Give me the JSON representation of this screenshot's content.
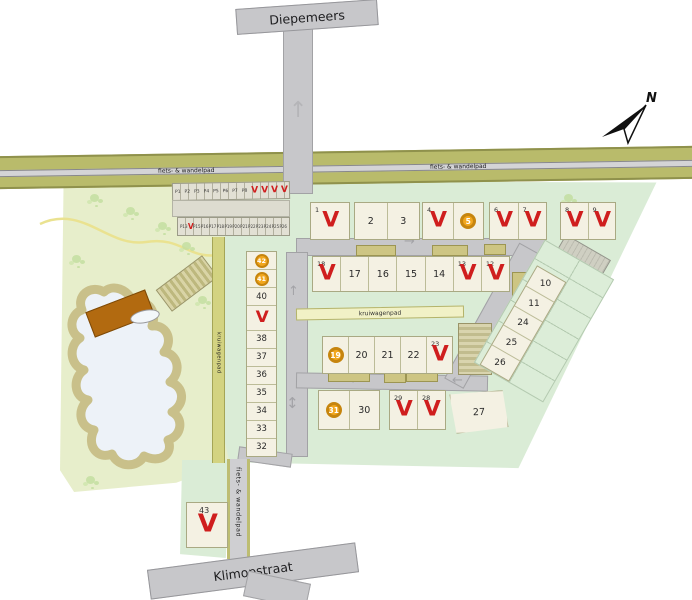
{
  "streets": {
    "top": "Diepemeers",
    "bottom": "Klimopstraat"
  },
  "paths": {
    "bike_top_left": "fiets- & wandelpad",
    "bike_top_right": "fiets- & wandelpad",
    "bike_south": "fiets- & wandelpad",
    "wheelbarrow": "kruiwagenpad",
    "wheelbarrow_side": "kruiwagenpad"
  },
  "compass": {
    "label": "N"
  },
  "markers": {
    "sold": "V"
  },
  "icons": {
    "arrow_up": "↑",
    "arrow_down": "↓",
    "arrow_left": "←",
    "arrow_right": "→",
    "arrow_up_down": "↕"
  },
  "colors": {
    "sold_red": "#cf1e1e",
    "option_orange": "#f2a71e",
    "plot_cream": "#f4f1e3",
    "site_green": "#daecd6",
    "field_green": "#e7eecb",
    "band_olive": "#b9bb6b",
    "road_gray": "#c7c7ca",
    "pond_water": "#edf2f8",
    "pond_bank": "#c9c08a",
    "deck_brown": "#b26a10"
  },
  "parking": {
    "row1": [
      "P1",
      "P2",
      "P3",
      "P4",
      "P5",
      "P6",
      "P7",
      "P8"
    ],
    "row2_first": "P13",
    "row2": [
      "P15",
      "P16",
      "P17",
      "P18",
      "P19",
      "P20",
      "P21",
      "P22",
      "P23",
      "P24",
      "P25",
      "P26"
    ]
  },
  "plots": {
    "top_row": [
      {
        "n": "1",
        "status": "sold"
      },
      {
        "n": "2",
        "status": "available"
      },
      {
        "n": "3",
        "status": "available"
      },
      {
        "n": "4",
        "status": "sold"
      },
      {
        "n": "5",
        "status": "option"
      },
      {
        "n": "6",
        "status": "sold"
      },
      {
        "n": "7",
        "status": "sold"
      },
      {
        "n": "8",
        "status": "sold"
      },
      {
        "n": "9",
        "status": "sold"
      }
    ],
    "row_mid": [
      {
        "n": "18",
        "status": "sold"
      },
      {
        "n": "17",
        "status": "available"
      },
      {
        "n": "16",
        "status": "available"
      },
      {
        "n": "15",
        "status": "available"
      },
      {
        "n": "14",
        "status": "available"
      },
      {
        "n": "13",
        "status": "sold"
      },
      {
        "n": "12",
        "status": "sold"
      }
    ],
    "row_inner": [
      {
        "n": "19",
        "status": "option"
      },
      {
        "n": "20",
        "status": "available"
      },
      {
        "n": "21",
        "status": "available"
      },
      {
        "n": "22",
        "status": "available"
      },
      {
        "n": "23",
        "status": "sold"
      }
    ],
    "row_bottom": [
      {
        "n": "31",
        "status": "option"
      },
      {
        "n": "30",
        "status": "available"
      },
      {
        "n": "29",
        "status": "sold"
      },
      {
        "n": "28",
        "status": "sold"
      },
      {
        "n": "27",
        "status": "available"
      }
    ],
    "left_col": [
      {
        "n": "42",
        "status": "option"
      },
      {
        "n": "41",
        "status": "option"
      },
      {
        "n": "40",
        "status": "available"
      },
      {
        "n": "39",
        "status": "sold"
      },
      {
        "n": "38",
        "status": "available"
      },
      {
        "n": "37",
        "status": "available"
      },
      {
        "n": "36",
        "status": "available"
      },
      {
        "n": "35",
        "status": "available"
      },
      {
        "n": "34",
        "status": "available"
      },
      {
        "n": "33",
        "status": "available"
      },
      {
        "n": "32",
        "status": "available"
      }
    ],
    "diagonal": [
      {
        "n": "10",
        "status": "available"
      },
      {
        "n": "11",
        "status": "available"
      },
      {
        "n": "24",
        "status": "available"
      },
      {
        "n": "25",
        "status": "available"
      },
      {
        "n": "26",
        "status": "available"
      }
    ],
    "south": {
      "n": "43",
      "status": "sold"
    }
  }
}
